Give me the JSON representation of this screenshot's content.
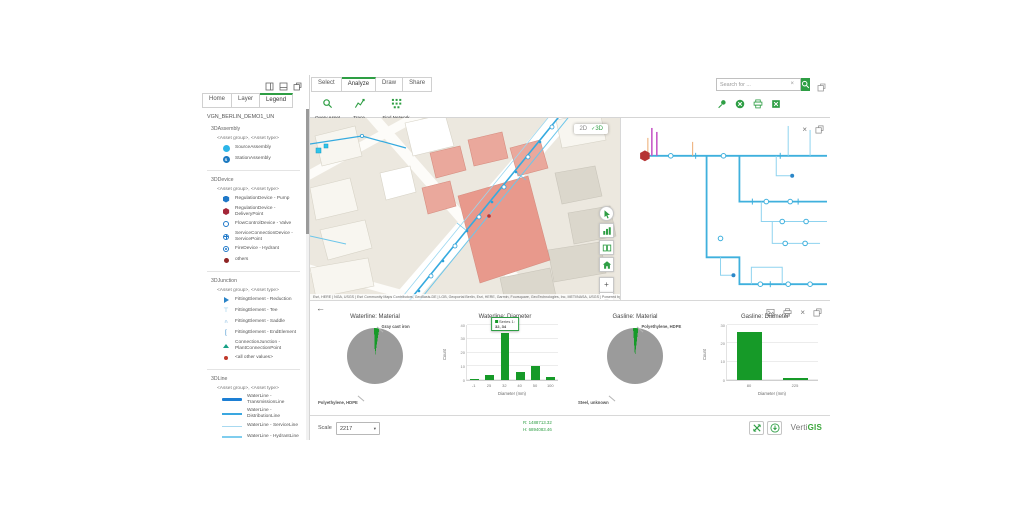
{
  "colors": {
    "accent": "#2e9e44",
    "bar_green": "#169a28",
    "pie_gray": "#9b9b9b",
    "line_blue": "#35aadf",
    "magenta": "#c14fc1"
  },
  "left_panel": {
    "tabs": [
      "Home",
      "Layer",
      "Legend"
    ],
    "active_tab": "Legend",
    "title": "VGN_BERLIN_DEMO1_UN",
    "subheading": "<Asset group>, <Asset type>",
    "sections": [
      {
        "heading": "3DAssembly",
        "items": [
          {
            "label": "SourceAssembly",
            "icon": "circle-cyan"
          },
          {
            "label": "StationAssembly",
            "icon": "circle-s"
          }
        ]
      },
      {
        "heading": "3DDevice",
        "items": [
          {
            "label": "RegulationDevice - Pump",
            "icon": "hex-blue"
          },
          {
            "label": "RegulationDevice - DeliveryPoint",
            "icon": "hex-red"
          },
          {
            "label": "FlowControlDevice - Valve",
            "icon": "ring-blue"
          },
          {
            "label": "ServiceConnectionDevice - ServicePoint",
            "icon": "gear-blue"
          },
          {
            "label": "FireDevice - Hydrant",
            "icon": "dot-ring-blue"
          },
          {
            "label": "others",
            "icon": "dot-darkred"
          }
        ]
      },
      {
        "heading": "3DJunction",
        "items": [
          {
            "label": "FittingElement - Reduction",
            "icon": "tri-blue"
          },
          {
            "label": "FittingElement - Tee",
            "icon": "tee-blue"
          },
          {
            "label": "FittingElement - Saddle",
            "icon": "saddle-blue"
          },
          {
            "label": "FittingElement - EndElement",
            "icon": "bracket-blue"
          },
          {
            "label": "ConnectionJunction - PlantConnectionPoint",
            "icon": "tri-green"
          },
          {
            "label": "<all other values>",
            "icon": "dot-red"
          }
        ]
      },
      {
        "heading": "3DLine",
        "items": [
          {
            "label": "WaterLine - TransmissionLine",
            "icon": "line-trans"
          },
          {
            "label": "WaterLine - DistributionLine",
            "icon": "line-dist"
          },
          {
            "label": "WaterLine - ServiceLine",
            "icon": "line-serv"
          },
          {
            "label": "WaterLine - HydrantLine",
            "icon": "line-hyd"
          },
          {
            "label": "WaterStationEquipmentLine - InternalLine",
            "icon": "line-int"
          }
        ]
      }
    ]
  },
  "ribbon": {
    "tabs": [
      "Select",
      "Analyze",
      "Draw",
      "Share"
    ],
    "active_tab": "Analyze",
    "buttons": [
      {
        "label": "Query Asset",
        "icon": "magnifier-icon"
      },
      {
        "label": "Trace",
        "icon": "trace-icon"
      },
      {
        "label": "Find Network Diagram",
        "icon": "network-diagram-icon"
      }
    ]
  },
  "search": {
    "placeholder": "Search for ..."
  },
  "map": {
    "view_options": [
      "2D",
      "3D"
    ],
    "selected_view": "3D",
    "attribution": "Esri, HERE | NGA, USGS | Esri Community Maps Contributors, GeoBasis-DE | LGB, Geoportal Berlin, Esri, HERE, Garmin, Foursquare, GeoTechnologies, Inc, METI/NASA, USGS | Powered by Esri"
  },
  "chart_data": [
    {
      "type": "pie",
      "title": "Waterline: Material",
      "start_deg": -2,
      "slices": [
        {
          "label": "Gray cast iron",
          "value": 3,
          "color": "#169a28"
        },
        {
          "label": "Polyethylene, HDPE",
          "value": 97,
          "color": "#9b9b9b"
        }
      ],
      "legend_position": "labels-with-leaders"
    },
    {
      "type": "bar",
      "title": "Waterline: Diameter",
      "categories": [
        "-1",
        "25",
        "32",
        "40",
        "50",
        "100"
      ],
      "values": [
        1,
        4,
        34,
        6,
        10,
        2
      ],
      "xlabel": "Diameter (mm)",
      "ylabel": "Count",
      "ylim": [
        0,
        40
      ],
      "yticks": [
        0,
        10,
        20,
        30,
        40
      ],
      "grid": true,
      "tooltip": {
        "series_label": "Series 1:",
        "value_text": "32, 34",
        "category": "32"
      }
    },
    {
      "type": "pie",
      "title": "Gasline: Material",
      "start_deg": -4,
      "slices": [
        {
          "label": "Polyethylene, HDPE",
          "value": 3,
          "color": "#169a28"
        },
        {
          "label": "Steel, unknown",
          "value": 97,
          "color": "#9b9b9b"
        }
      ],
      "legend_position": "labels-with-leaders"
    },
    {
      "type": "bar",
      "title": "Gasline: Diameter",
      "categories": [
        "80",
        "225"
      ],
      "values": [
        26,
        1
      ],
      "xlabel": "Diameter (mm)",
      "ylabel": "Count",
      "ylim": [
        0,
        30
      ],
      "yticks": [
        0,
        10,
        20,
        30
      ],
      "grid": true
    }
  ],
  "statusbar": {
    "scale_label": "Scale",
    "scale_value": "2217",
    "coord_line1": "R: 1488713.32",
    "coord_line2": "H: 6894083.46",
    "brand_gray": "Verti",
    "brand_green": "GIS"
  }
}
